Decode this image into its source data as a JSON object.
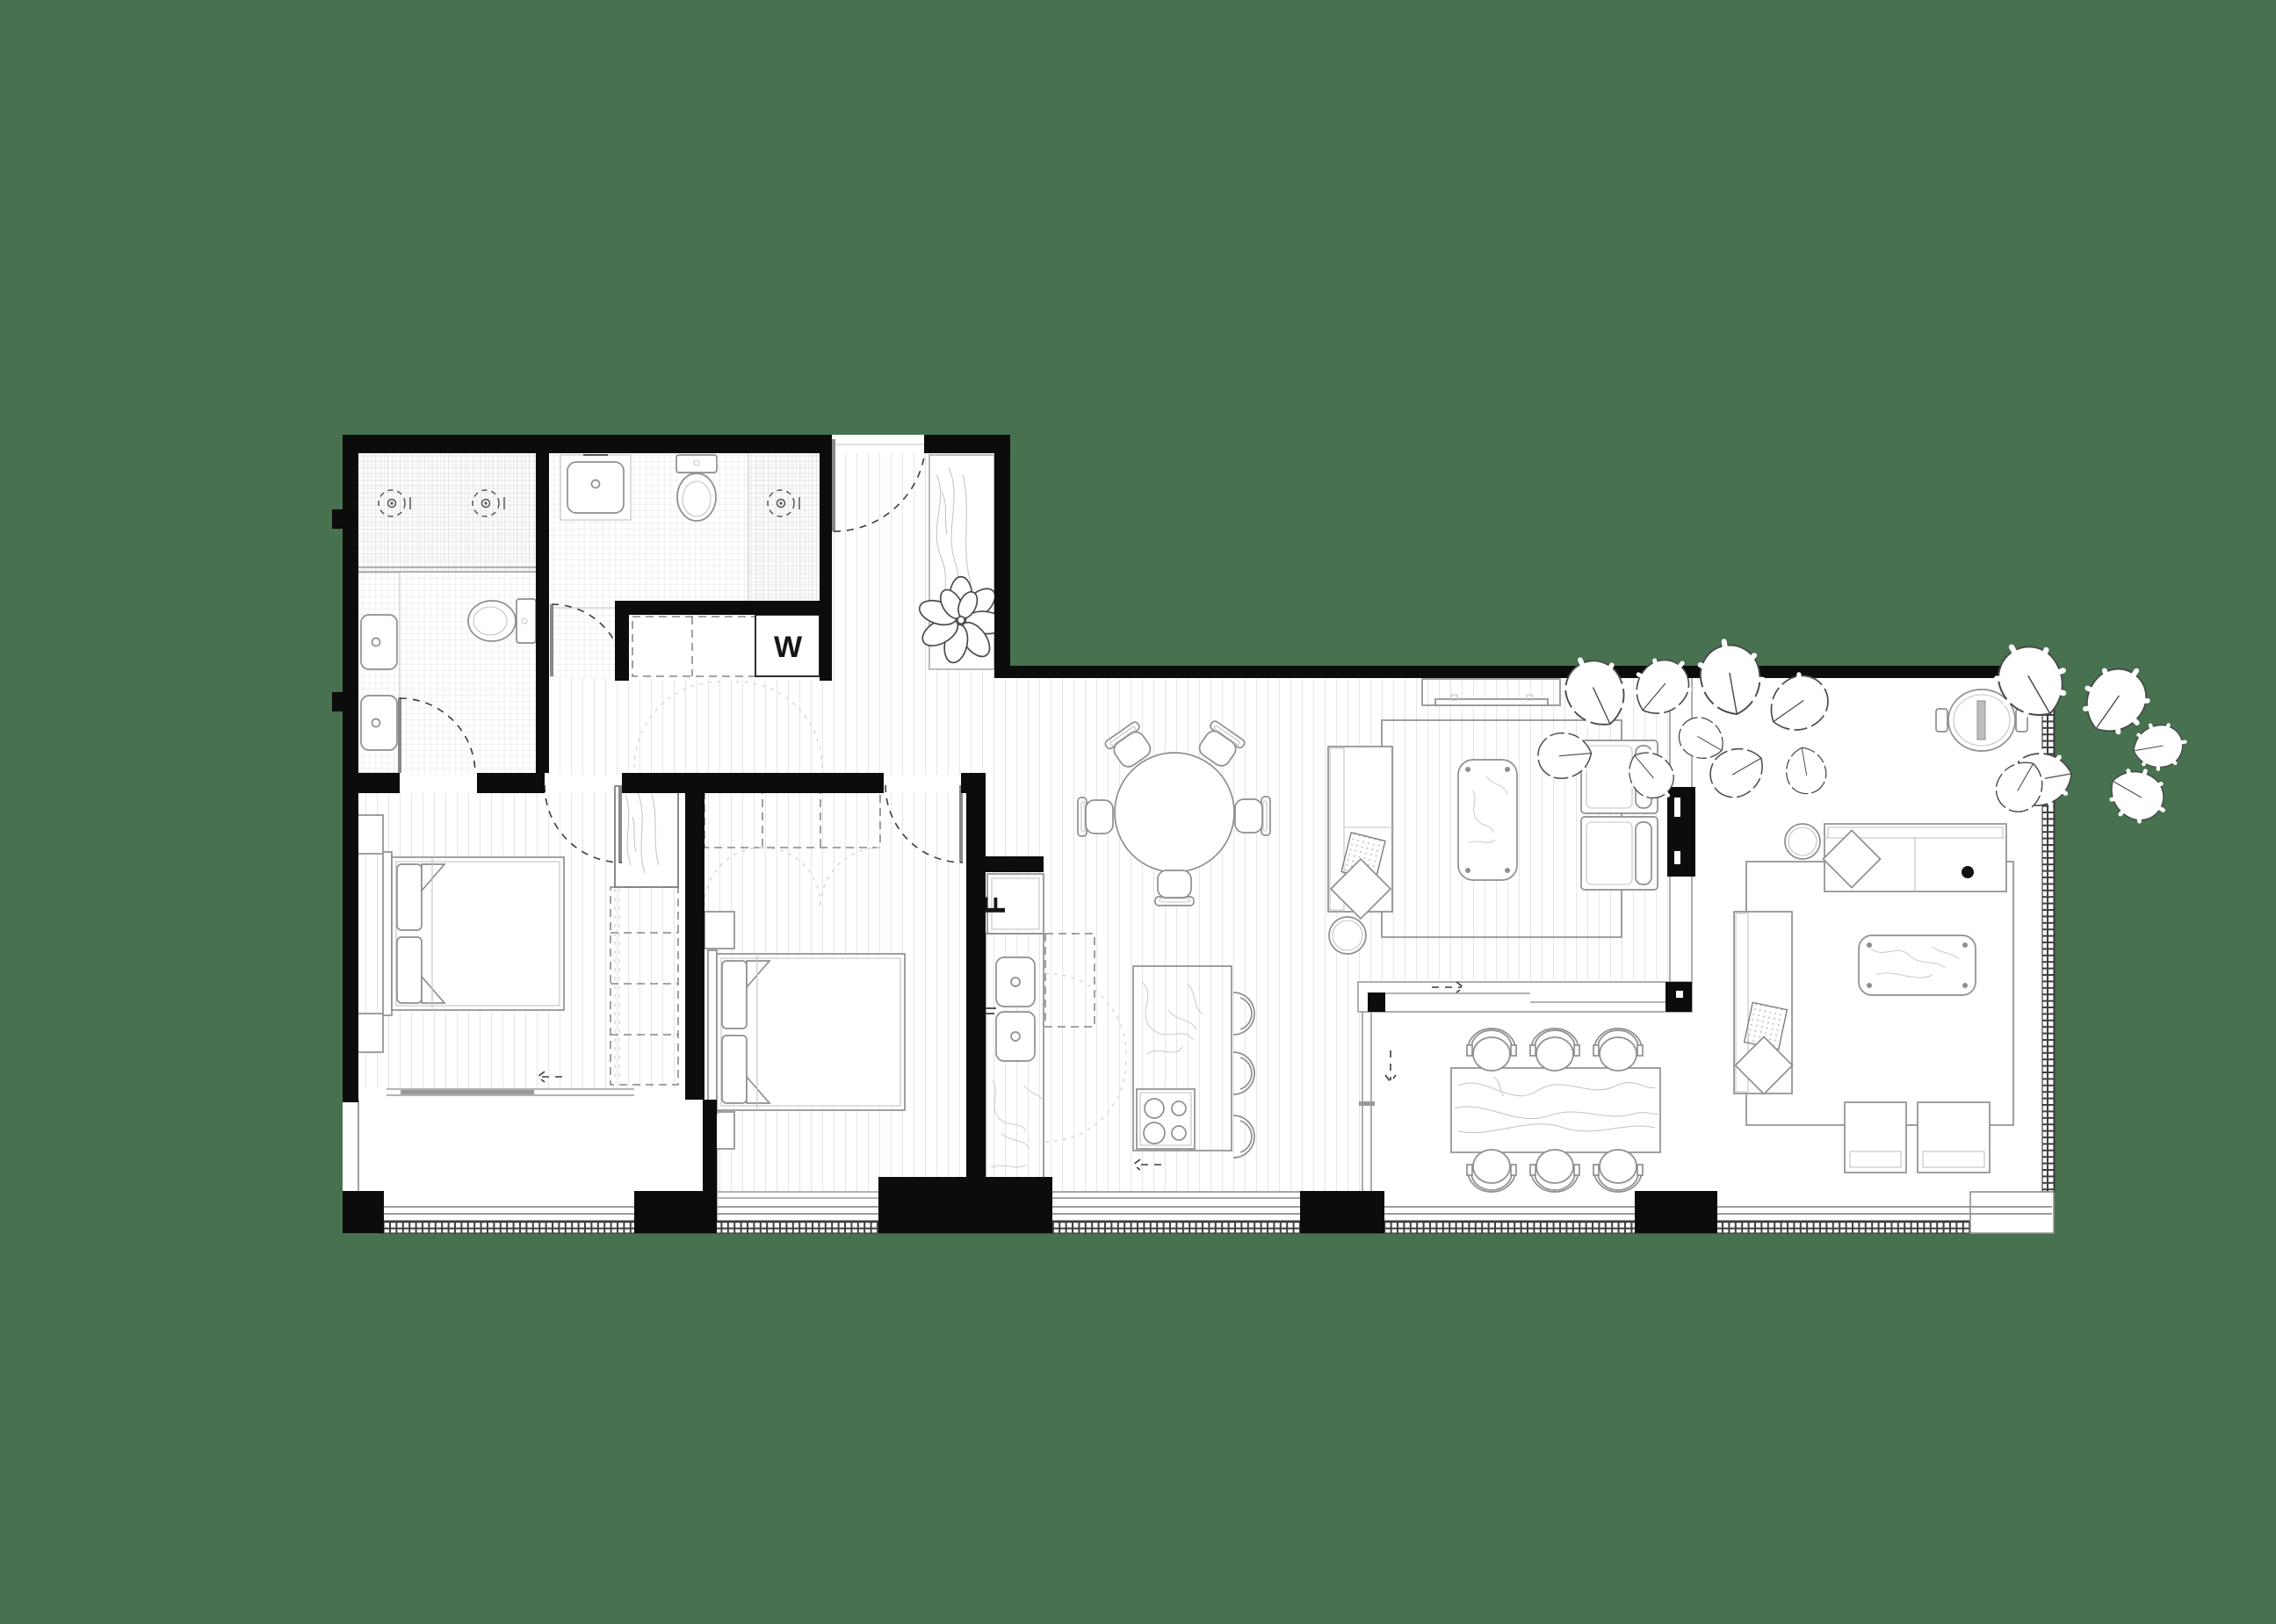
{
  "page": {
    "background_color": "#47714F",
    "wall_ink": "#0C0C0C",
    "line_grey": "#8F8F8F",
    "floor_color": "#FFFFFF"
  },
  "labels": {
    "washing_machine": "W",
    "fridge": "F"
  }
}
